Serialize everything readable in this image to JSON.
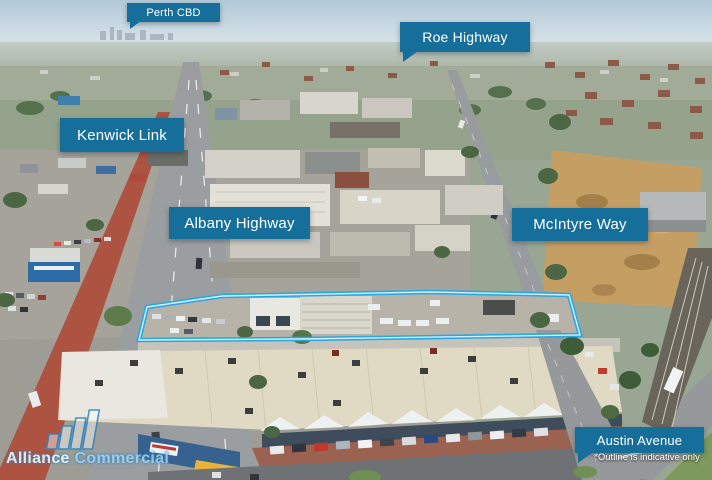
{
  "callouts": {
    "bg_color": "#156f9a",
    "labels": [
      {
        "name": "perth-cbd",
        "text": "Perth CBD"
      },
      {
        "name": "roe-highway",
        "text": "Roe Highway"
      },
      {
        "name": "kenwick-link",
        "text": "Kenwick Link"
      },
      {
        "name": "albany-highway",
        "text": "Albany Highway"
      },
      {
        "name": "mcintyre-way",
        "text": "McIntyre Way"
      },
      {
        "name": "austin-avenue",
        "text": "Austin Avenue"
      }
    ],
    "disclaimer": "*Outline is indicative only"
  },
  "property_outline": {
    "color": "#2aa7e0",
    "inner_color": "#d6f1fd"
  },
  "watermark": {
    "word1": "Alliance",
    "word2": "Commercial",
    "accent": "#2f86c4"
  }
}
